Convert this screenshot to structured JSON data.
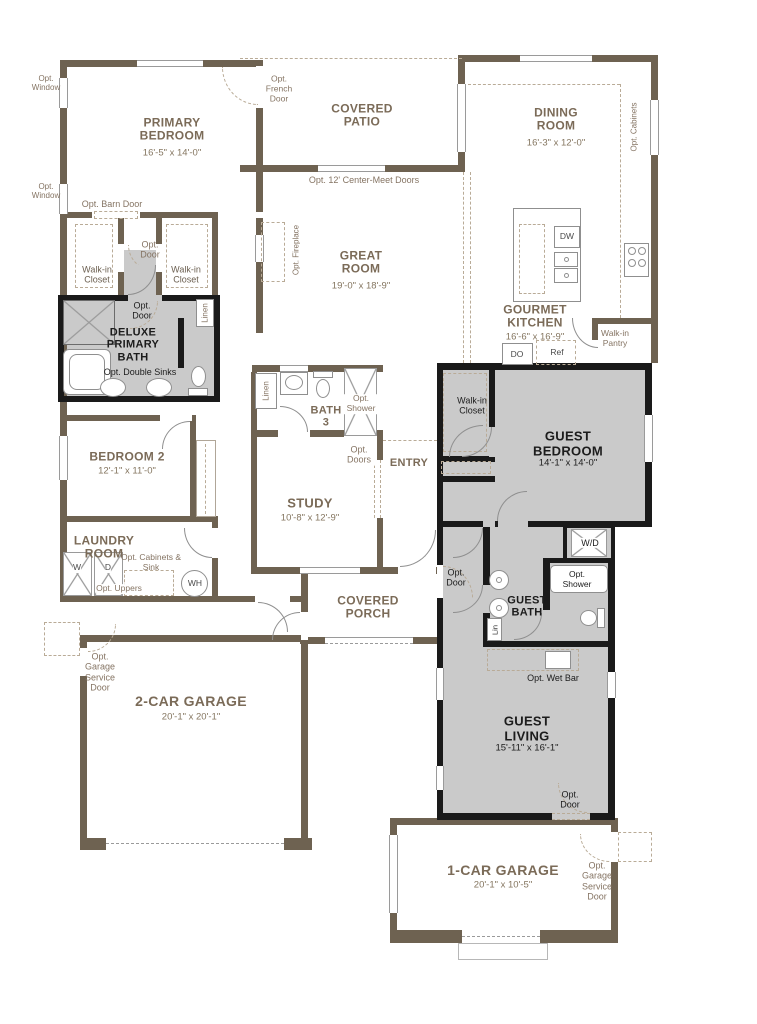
{
  "rooms": {
    "primary_bedroom": {
      "name": "PRIMARY BEDROOM",
      "dims": "16'-5\" x 14'-0\""
    },
    "covered_patio": {
      "name": "COVERED PATIO"
    },
    "dining_room": {
      "name": "DINING ROOM",
      "dims": "16'-3\" x 12'-0\""
    },
    "great_room": {
      "name": "GREAT ROOM",
      "dims": "19'-0\" x 18'-9\""
    },
    "gourmet_kitchen": {
      "name": "GOURMET KITCHEN",
      "dims": "16'-6\" x 16'-9\""
    },
    "deluxe_primary_bath": {
      "name": "DELUXE PRIMARY BATH"
    },
    "bedroom_2": {
      "name": "BEDROOM 2",
      "dims": "12'-1\" x 11'-0\""
    },
    "bath_3": {
      "name": "BATH 3"
    },
    "laundry_room": {
      "name": "LAUNDRY ROOM"
    },
    "study": {
      "name": "STUDY",
      "dims": "10'-8\" x 12'-9\""
    },
    "entry": {
      "name": "ENTRY"
    },
    "guest_bedroom": {
      "name": "GUEST BEDROOM",
      "dims": "14'-1\" x 14'-0\""
    },
    "guest_bath": {
      "name": "GUEST BATH"
    },
    "guest_living": {
      "name": "GUEST LIVING",
      "dims": "15'-11\" x 16'-1\""
    },
    "covered_porch": {
      "name": "COVERED PORCH"
    },
    "two_car_garage": {
      "name": "2-CAR GARAGE",
      "dims": "20'-1\" x 20'-1\""
    },
    "one_car_garage": {
      "name": "1-CAR GARAGE",
      "dims": "20'-1\" x 10'-5\""
    },
    "walk_in_pantry": {
      "name": "Walk-in Pantry"
    }
  },
  "annotations": {
    "opt_window": "Opt. Window",
    "opt_french_door": "Opt. French Door",
    "opt_center_meet_doors": "Opt. 12' Center-Meet Doors",
    "opt_cabinets": "Opt. Cabinets",
    "opt_fireplace": "Opt. Fireplace",
    "opt_barn_door": "Opt. Barn Door",
    "opt_door": "Opt. Door",
    "opt_double_sinks": "Opt. Double Sinks",
    "walk_in_closet": "Walk-in Closet",
    "linen": "Linen",
    "lin": "Lin",
    "opt_shower": "Opt. Shower",
    "opt_doors": "Opt. Doors",
    "opt_cabinets_sink": "Opt. Cabinets & Sink",
    "opt_uppers": "Opt. Uppers",
    "opt_wet_bar": "Opt. Wet Bar",
    "opt_garage_service_door": "Opt. Garage Service Door"
  },
  "fixtures": {
    "dishwasher": "DW",
    "double_oven": "DO",
    "refrigerator": "Ref",
    "washer": "W",
    "dryer": "D",
    "water_heater": "WH",
    "washer_dryer": "W/D"
  },
  "colors": {
    "wall_brown": "#6e6251",
    "wall_black": "#1a1a1a",
    "option_room_fill": "#cacaca",
    "dashed_option": "#b9ab97",
    "label_brown": "#7b6b58",
    "label_black": "#1c1c1c",
    "fixture_line": "#8f8f8f"
  }
}
